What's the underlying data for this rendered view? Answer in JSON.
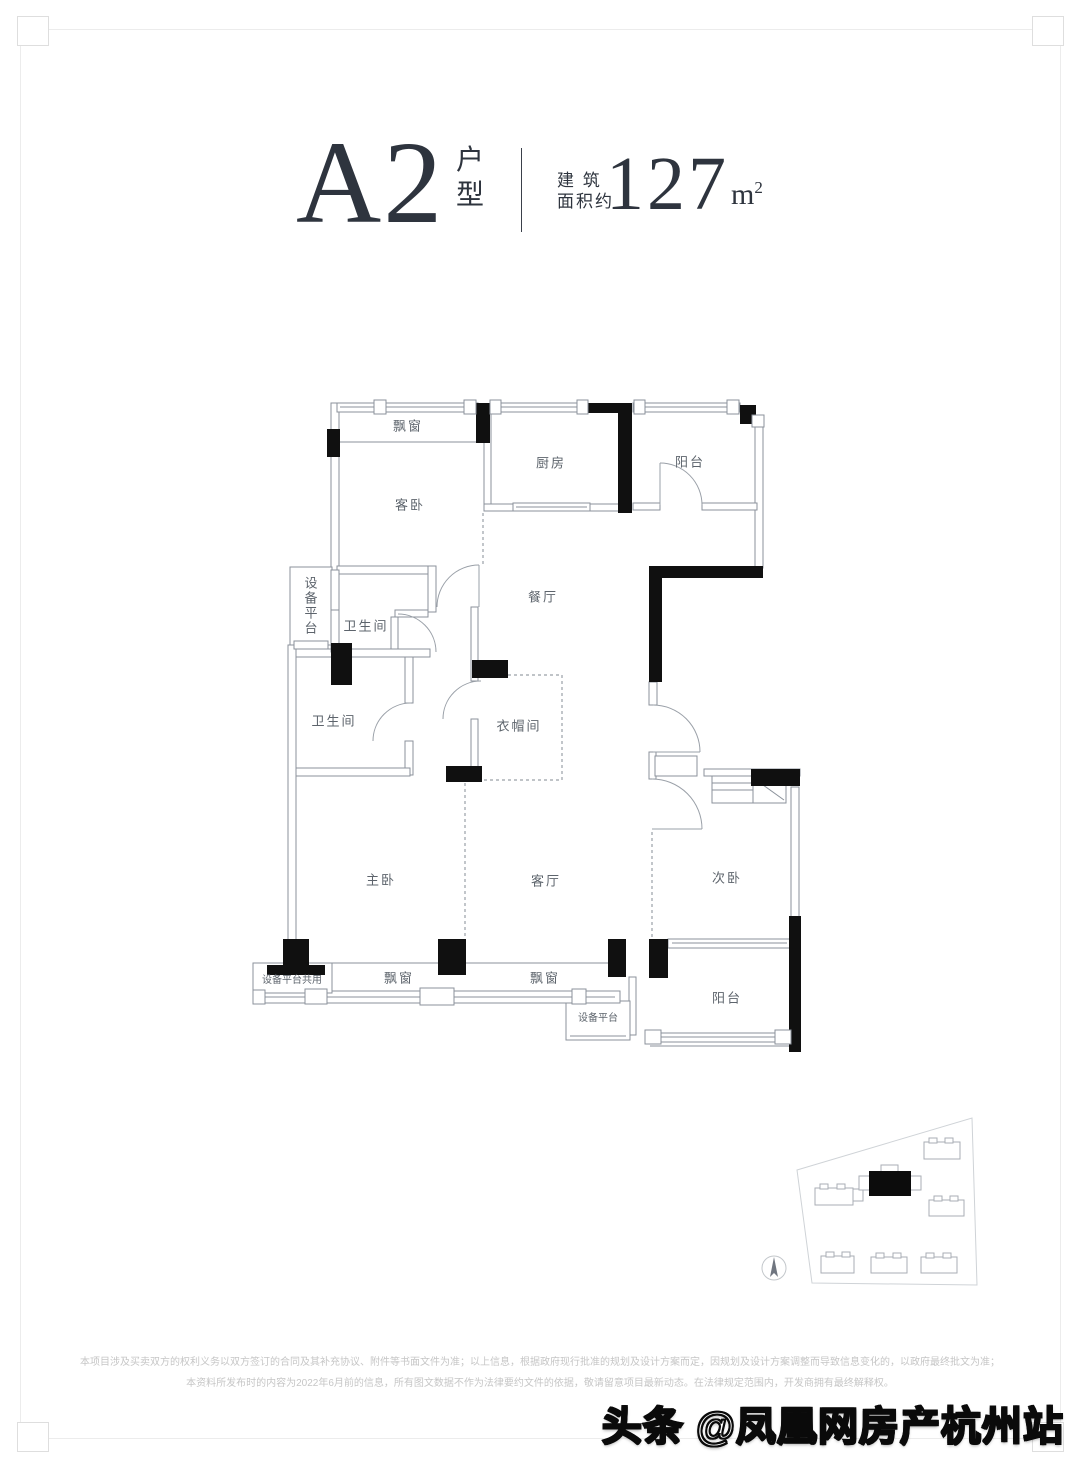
{
  "title": {
    "unit_code": "A2",
    "unit_type_chars": {
      "c1": "户",
      "c2": "型"
    },
    "area_label_line1": "建 筑",
    "area_label_line2": "面积约",
    "area_value": "127",
    "area_unit": "m",
    "area_unit_sup": "2"
  },
  "rooms": [
    {
      "label": "飘窗"
    },
    {
      "label": "厨房"
    },
    {
      "label": "阳台"
    },
    {
      "label": "客卧"
    },
    {
      "label": "设备平台"
    },
    {
      "label": "卫生间"
    },
    {
      "label": "餐厅"
    },
    {
      "label": "卫生间"
    },
    {
      "label": "衣帽间"
    },
    {
      "label": "主卧"
    },
    {
      "label": "客厅"
    },
    {
      "label": "次卧"
    },
    {
      "label": "设备平台共用"
    },
    {
      "label": "飘窗"
    },
    {
      "label": "飘窗"
    },
    {
      "label": "设备平台"
    },
    {
      "label": "阳台"
    }
  ],
  "disclaimer": {
    "line1": "本项目涉及买卖双方的权利义务以双方签订的合同及其补充协议、附件等书面文件为准；以上信息，根据政府现行批准的规划及设计方案而定，因规划及设计方案调整而导致信息变化的，以政府最终批文为准；",
    "line2": "本资料所发布时的内容为2022年6月前的信息，所有图文数据不作为法律要约文件的依据，敬请留意项目最新动态。在法律规定范围内，开发商拥有最终解释权。"
  },
  "watermark": {
    "text": "头条 @凤凰网房产杭州站"
  },
  "colors": {
    "title_text": "#2e343e",
    "wall_thin": "#8b929b",
    "wall_structural": "#101010",
    "room_label": "#5d646c",
    "disclaimer_text": "#c6c6c6",
    "site_plan_outline": "#a9aeb4"
  }
}
